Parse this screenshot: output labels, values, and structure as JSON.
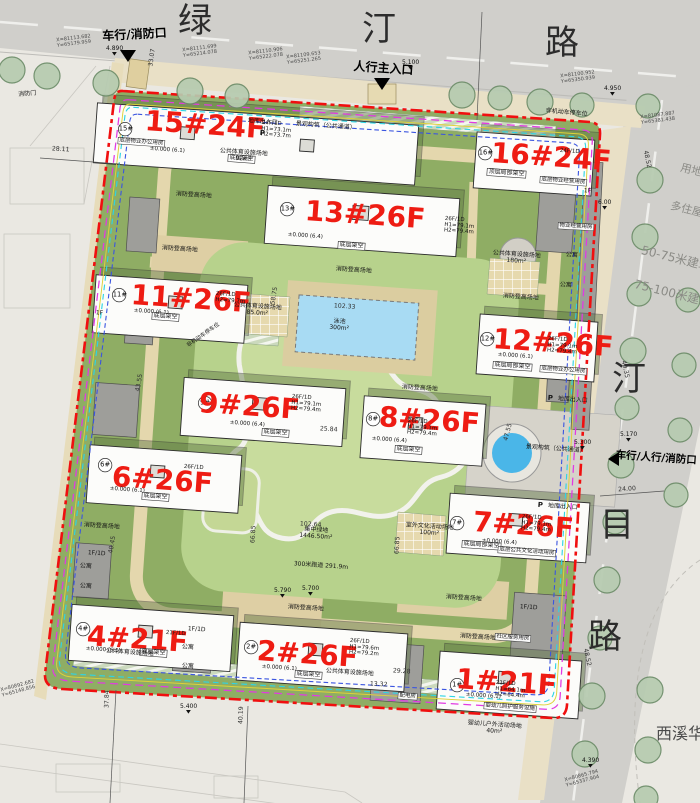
{
  "roads": {
    "top": [
      "绿",
      "汀",
      "路"
    ],
    "right": [
      "汀",
      "目",
      "路"
    ]
  },
  "entrances": {
    "vehicle_fire": "车行/消防口",
    "pedestrian_main": "人行主入口",
    "vehicle_ped_fire": "车行/人行/消防口"
  },
  "buildings": [
    {
      "num": "15#",
      "label": "15#24F"
    },
    {
      "num": "16#",
      "label": "16#24F"
    },
    {
      "num": "13#",
      "label": "13#26F"
    },
    {
      "num": "11#",
      "label": "11#26F"
    },
    {
      "num": "12#",
      "label": "12#26F"
    },
    {
      "num": "9#",
      "label": "9#26F"
    },
    {
      "num": "8#",
      "label": "8#26F"
    },
    {
      "num": "6#",
      "label": "6#26F"
    },
    {
      "num": "7#",
      "label": "7#26F"
    },
    {
      "num": "4#",
      "label": "4#21F"
    },
    {
      "num": "2#",
      "label": "2#26F"
    },
    {
      "num": "1#",
      "label": "1#21F"
    }
  ],
  "specs": {
    "f26": "26F/1D",
    "f24": "24F/1D",
    "f21": "21F/1D",
    "h1_79": "H1=79.1m",
    "h2_79": "H2=79.4m",
    "h2_797": "H2=79.7m",
    "h1_73": "H1=73.1m",
    "h2_73": "H2=73.7m",
    "h1_796": "H1=79.6m",
    "h2_792": "H2=79.2m",
    "h1_64": "H1=64.1m",
    "h2_64": "H2=64.4m",
    "zero61": "±0.000 (6.1)",
    "zero64": "±0.000 (6.4)"
  },
  "tags": {
    "stilt": "底层架空",
    "partial_stilt": "底层局部架空",
    "top_stilt": "顶层局部架空",
    "pm_office": "底层物业办公用房",
    "pm_biz": "底层物业经营用房",
    "culture_room": "底层公共文化活动用房",
    "nursery": "婴幼儿照护服务设施",
    "community": "社区服务用房",
    "apartment": "公寓",
    "power": "配电房",
    "property": "物业经营用房",
    "fire_door": "消防门",
    "f1d": "1F/1D",
    "f1": "1F"
  },
  "grounds": {
    "fire_field": "消防登高场地",
    "pool": "泳池",
    "pool_area": "300m²",
    "green": "集中绿地",
    "green_area": "1446.50m²",
    "track": "300米跑道 291.9m",
    "culture": "室外文化活动场地",
    "culture_area": "100m²",
    "sport": "公共体育设施场地",
    "sport92": "92m²",
    "sport85": "85.0m²",
    "sport180": "180m²",
    "landscape": "景观构筑（公共通道）",
    "bike": "非机动车停车位",
    "garage": "地库出入口",
    "p": "P",
    "nursery_out": "婴幼儿户外活动场地",
    "nursery_out_area": "40m²"
  },
  "coords": [
    {
      "x": "X=81113.682",
      "y": "Y=65179.959"
    },
    {
      "x": "X=81111.699",
      "y": "Y=65214.078"
    },
    {
      "x": "X=81110.906",
      "y": "Y=65222.078"
    },
    {
      "x": "X=81109.653",
      "y": "Y=65251.265"
    },
    {
      "x": "X=81100.952",
      "y": "Y=65350.939"
    },
    {
      "x": "X=81087.887",
      "y": "Y=65381.438"
    },
    {
      "x": "X=80865.794",
      "y": "Y=65337.904"
    },
    {
      "x": "X=80892.682",
      "y": "Y=65148.856"
    }
  ],
  "dims": {
    "d1": "28.11",
    "d2": "33.07",
    "d3": "24.00",
    "d4": "40.35",
    "d5": "48.52",
    "d6": "37.84",
    "d7": "40.19",
    "d8": "102.64",
    "d9": "66.85",
    "d10": "102.33",
    "d11": "13.32",
    "d12": "29.28",
    "d13": "58.75",
    "d14": "43.55",
    "d15": "40.45",
    "d16": "25.84",
    "d17": "47.55"
  },
  "elev": {
    "e1": "4.890",
    "e2": "5.100",
    "e3": "4.950",
    "e4": "6.00",
    "e5": "5.170",
    "e6": "5.300",
    "e7": "5.700",
    "e8": "5.400",
    "e9": "4.390",
    "e10": "5.790"
  },
  "notes": {
    "n1": "50-75米建筑",
    "n2": "75-100米建筑",
    "n3": "用地",
    "n4": "多住屋",
    "adjacent": "西溪华府"
  }
}
